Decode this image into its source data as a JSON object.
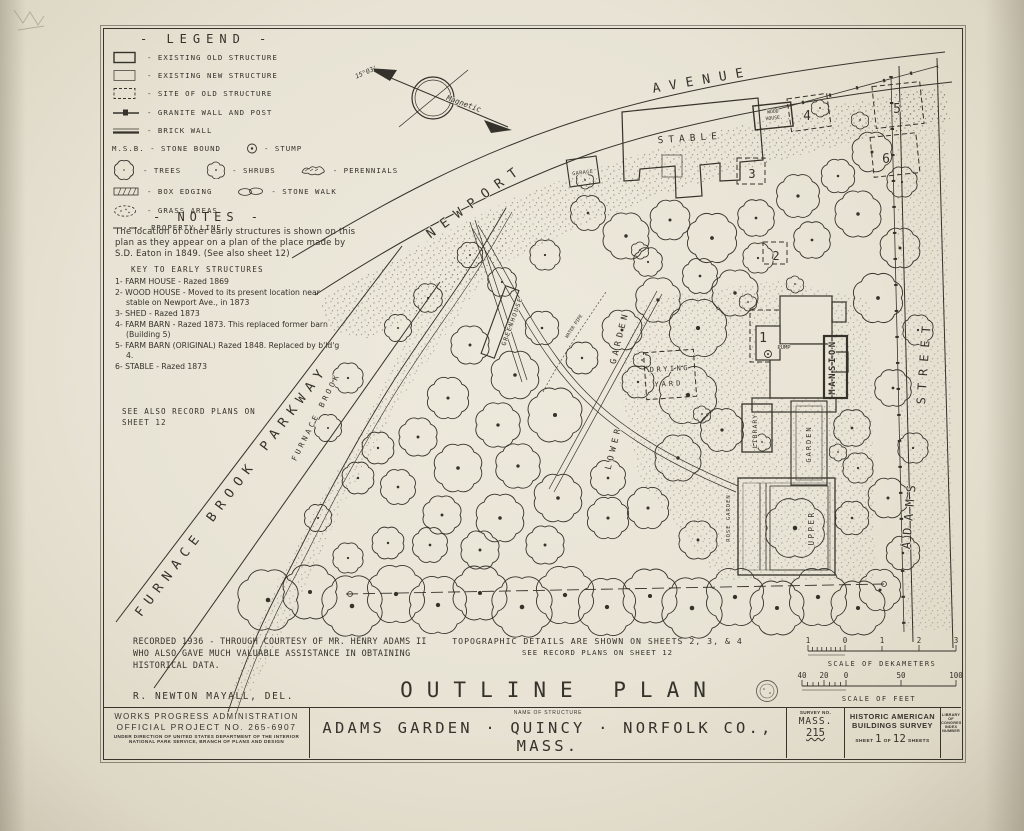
{
  "legend": {
    "title": "- LEGEND -",
    "old_structure": "- EXISTING OLD STRUCTURE",
    "new_structure": "- EXISTING NEW STRUCTURE",
    "site_old_structure": "- SITE OF OLD STRUCTURE",
    "granite_wall": "- GRANITE WALL AND POST",
    "brick_wall": "- BRICK WALL",
    "stone_bound": "M.S.B. - STONE BOUND",
    "stump": "- STUMP",
    "trees": "- TREES",
    "shrubs": "- SHRUBS",
    "perennials": "- PERENNIALS",
    "box_edging": "- BOX EDGING",
    "stone_walk": "- STONE WALK",
    "grass_areas": "- GRASS AREAS",
    "property_line": "PROPERTY LINE"
  },
  "notes": {
    "title": "- NOTES -",
    "body": "The location of other early structures is shown on this plan as they appear on a plan of the place made by S.D. Eaton in 1849. (See also sheet 12)",
    "key_title": "KEY TO EARLY STRUCTURES",
    "key_items": [
      "1- FARM HOUSE - Razed 1869",
      "2- WOOD HOUSE - Moved to its present location near stable on Newport Ave., in 1873",
      "3- SHED - Razed 1873",
      "4- FARM BARN - Razed 1873. This replaced former barn (Building 5)",
      "5- FARM BARN (ORIGINAL) Razed 1848. Replaced by b'ld'g 4.",
      "6- STABLE - Razed 1873"
    ],
    "see_also": "SEE ALSO RECORD PLANS ON SHEET 12"
  },
  "compass": {
    "declination": "15°03'",
    "magnetic": "Magnetic"
  },
  "map": {
    "newport": "NEWPORT",
    "avenue": "AVENUE",
    "adams": "ADAMS",
    "street": "STREET",
    "parkway": "FURNACE BROOK PARKWAY",
    "furnace_brook": "FURNACE BROOK",
    "stable": "STABLE",
    "garage": "GARAGE",
    "wood_house_line1": "WOOD",
    "wood_house_line2": "HOUSE",
    "mansion": "MANSION",
    "library": "LIBRARY",
    "garden": "GARDEN",
    "drying_line1": "DRYING",
    "drying_line2": "YARD",
    "rose_garden": "ROSE GARDEN",
    "upper": "UPPER",
    "lower": "LOWER",
    "lower_garden_word": "GARDEN",
    "greenhouse": "GREENHOUSE",
    "pump": "PUMP",
    "water_pipe": "WATER PIPE",
    "site_numbers": [
      "1",
      "2",
      "3",
      "4",
      "5",
      "6"
    ]
  },
  "plan_notes": {
    "recorded": "RECORDED 1936 - THROUGH COURTESY OF MR. HENRY ADAMS II  WHO ALSO GAVE MUCH VALUABLE ASSISTANCE IN OBTAINING HISTORICAL DATA.",
    "delineator": "R. NEWTON MAYALL, DEL.",
    "topo_1": "TOPOGRAPHIC DETAILS ARE SHOWN ON SHEETS 2, 3, & 4",
    "topo_2": "SEE RECORD PLANS ON SHEET 12",
    "plan_title": "OUTLINE PLAN"
  },
  "scales": {
    "dekameters": {
      "label": "SCALE OF DEKAMETERS",
      "ticks": [
        "1",
        "0",
        "1",
        "2",
        "3"
      ]
    },
    "feet": {
      "label": "SCALE OF FEET",
      "ticks": [
        "40",
        "20",
        "0",
        "50",
        "100"
      ]
    }
  },
  "title_block": {
    "agency_line1": "WORKS PROGRESS ADMINISTRATION",
    "agency_line2": "OFFICIAL PROJECT NO. 265-6907",
    "agency_line3": "UNDER DIRECTION OF UNITED STATES DEPARTMENT OF THE INTERIOR",
    "agency_line4": "NATIONAL PARK SERVICE, BRANCH OF PLANS AND DESIGN",
    "name_of_structure_label": "NAME OF STRUCTURE",
    "structure_name": "ADAMS GARDEN · QUINCY · NORFOLK CO., MASS.",
    "survey_no_label": "SURVEY NO.",
    "survey_no_line1": "MASS.",
    "survey_no_line2": "215",
    "habs_line1": "HISTORIC AMERICAN",
    "habs_line2": "BUILDINGS SURVEY",
    "sheet_prefix": "SHEET",
    "sheet_number": "1",
    "sheet_of": "OF",
    "sheet_total": "12",
    "sheet_suffix": "SHEETS",
    "loc_line1": "LIBRARY OF CONGRESS",
    "loc_line2": "INDEX NUMBER"
  }
}
